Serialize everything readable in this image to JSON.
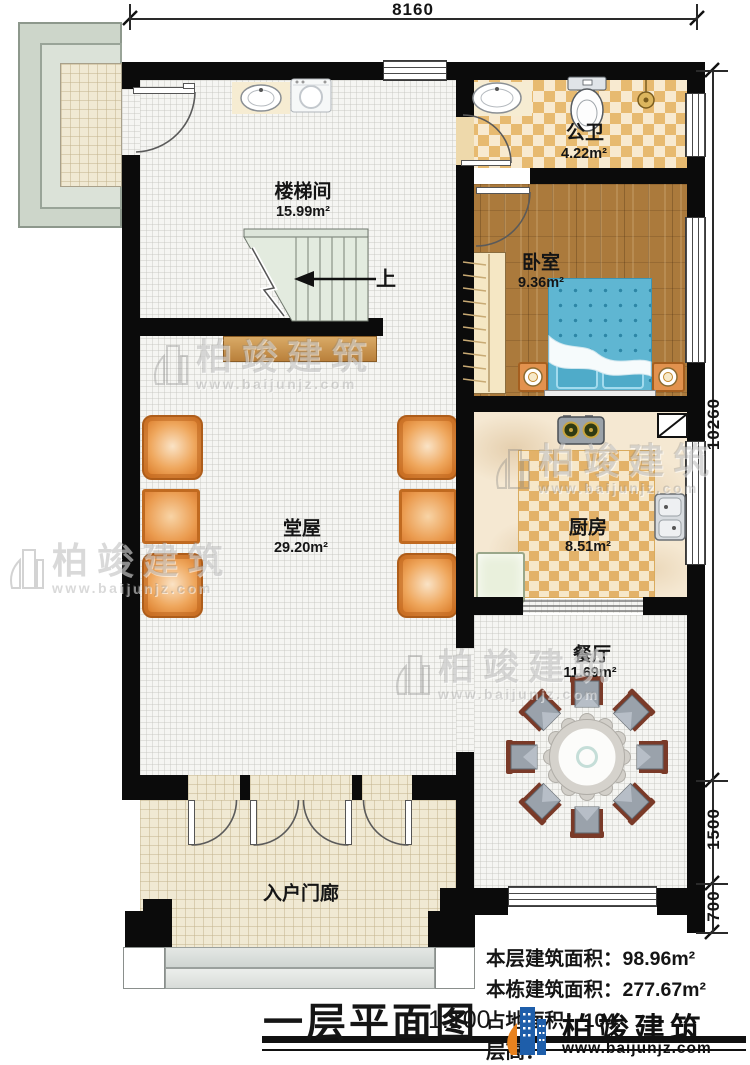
{
  "title": {
    "text": "一层平面图",
    "scale": "1:100"
  },
  "dimensions": {
    "top_width": "8160",
    "right_upper": "10260",
    "right_middle": "1500",
    "right_lower": "700"
  },
  "rooms": [
    {
      "id": "stairwell",
      "name": "楼梯间",
      "area": "15.99m²"
    },
    {
      "id": "bathroom",
      "name": "公卫",
      "area": "4.22m²"
    },
    {
      "id": "bedroom",
      "name": "卧室",
      "area": "9.36m²"
    },
    {
      "id": "kitchen",
      "name": "厨房",
      "area": "8.51m²"
    },
    {
      "id": "hall",
      "name": "堂屋",
      "area": "29.20m²"
    },
    {
      "id": "dining",
      "name": "餐厅",
      "area": "11.69m²"
    },
    {
      "id": "porch",
      "name": "入户门廊",
      "area": ""
    }
  ],
  "stairs": {
    "direction_label": "上"
  },
  "info": {
    "floor_area_label": "本层建筑面积：",
    "floor_area_value": "98.96m²",
    "building_area_label": "本栋建筑面积：",
    "building_area_value": "277.67m²",
    "land_area_label": "占地面积：",
    "land_area_value": "104.",
    "floor_height_label": "层高：",
    "floor_height_value": ""
  },
  "brand": {
    "name": "柏竣建筑",
    "website": "www.baijunjz.com"
  },
  "colors": {
    "wall": "#0b0b0b",
    "checker_dark": "#e7ba70",
    "checker_light": "#f8ead0",
    "wood_floor": "#ab7a3c",
    "bed_blue": "#5fb6d2",
    "furniture_orange": "#e08c4e",
    "outdoor_green": "#ccd6c8",
    "logo_blue": "#1e5eaa",
    "logo_orange": "#e8821e"
  }
}
